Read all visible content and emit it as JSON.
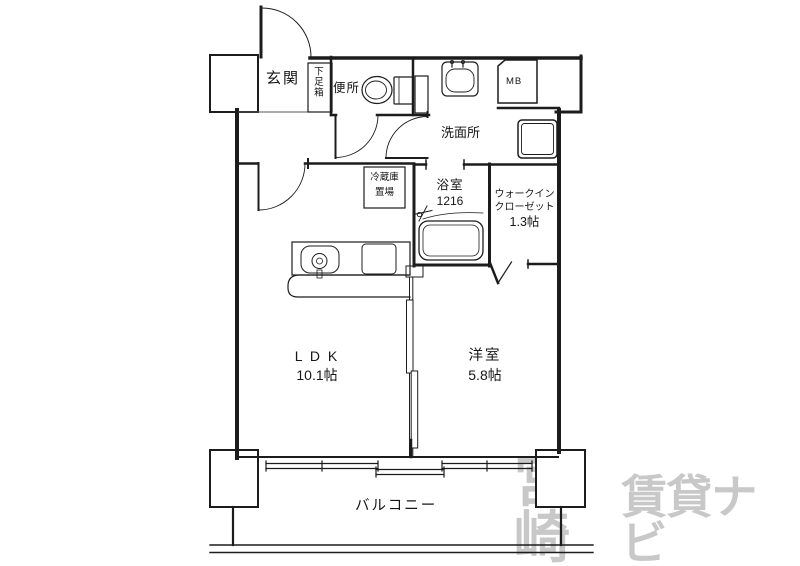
{
  "watermark": {
    "part1": "宮崎",
    "part2": "賃貸ナビ"
  },
  "rooms": {
    "genkan": {
      "label": "玄関"
    },
    "shoebox": {
      "label": "下足箱"
    },
    "toilet": {
      "label": "便所"
    },
    "meter_box": {
      "label": "MB"
    },
    "washroom": {
      "label": "洗面所"
    },
    "fridge": {
      "line1": "冷蔵庫",
      "line2": "置場"
    },
    "bathroom": {
      "label": "浴室",
      "size": "1216"
    },
    "closet": {
      "line1": "ウォークイン",
      "line2": "クローゼット",
      "size": "1.3帖"
    },
    "ldk": {
      "label": "L D K",
      "size": "10.1帖"
    },
    "bedroom": {
      "label": "洋室",
      "size": "5.8帖"
    },
    "balcony": {
      "label": "バルコニー"
    }
  },
  "colors": {
    "line": "#1c1c1c",
    "watermark": "#c8c8c8",
    "background": "#ffffff"
  }
}
